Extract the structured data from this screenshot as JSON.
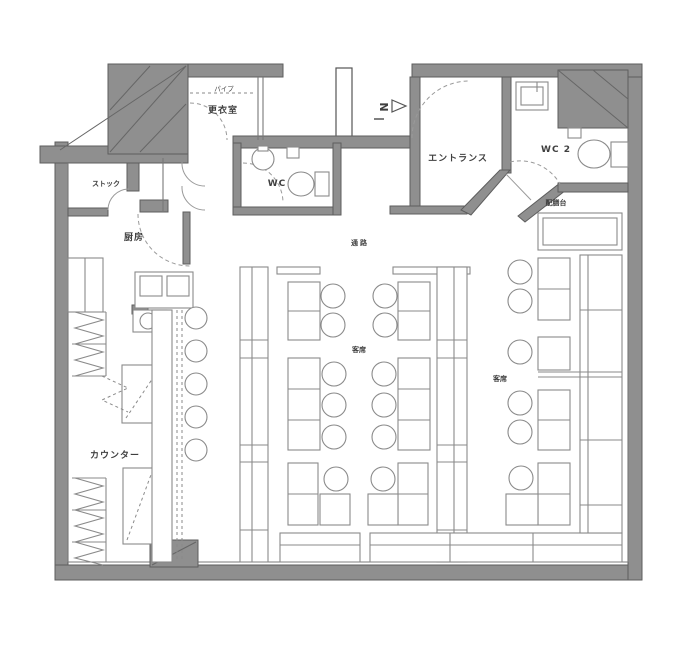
{
  "meta": {
    "drawing_type": "restaurant floor plan",
    "language": "Japanese"
  },
  "colors": {
    "background": "#ffffff",
    "wall_fill": "#8f8f8f",
    "wall_edge": "#5e5e5e",
    "furniture_line": "#8a8a8a",
    "text": "#3f3f3f"
  },
  "north_arrow": {
    "label": "N"
  },
  "rooms": {
    "changing_room": {
      "label": "更衣室"
    },
    "hanger_pipe": {
      "label": "パイプ"
    },
    "wc": {
      "label": "WC"
    },
    "entrance": {
      "label": "エントランス"
    },
    "wc2": {
      "label": "WC 2"
    },
    "serving_table": {
      "label": "配膳台"
    },
    "stock": {
      "label": "ストック"
    },
    "kitchen": {
      "label": "厨房"
    },
    "aisle": {
      "label": "通路"
    },
    "seating_center": {
      "label": "客席"
    },
    "seating_right": {
      "label": "客席"
    },
    "counter": {
      "label": "カウンター"
    }
  }
}
